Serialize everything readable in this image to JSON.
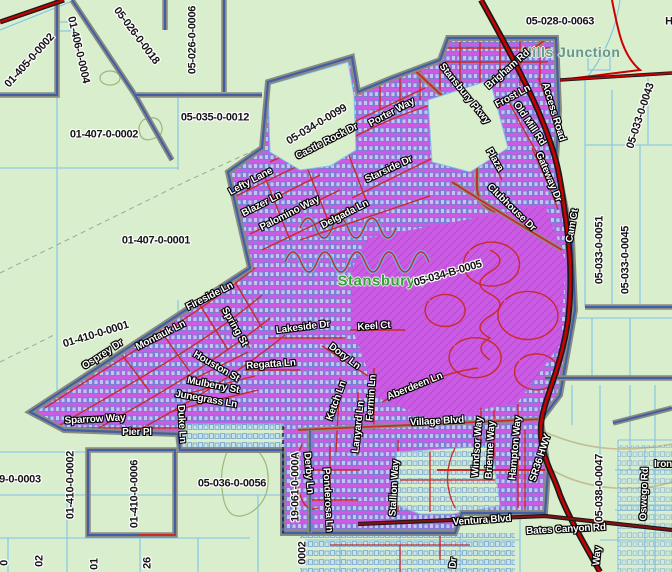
{
  "map": {
    "place_labels": [
      {
        "t": "Hills Junction",
        "x": 571,
        "y": 52,
        "r": 0,
        "k": "place-teal"
      },
      {
        "t": "Stansbury P",
        "x": 384,
        "y": 281,
        "r": 0,
        "k": "place-green"
      }
    ],
    "parcel_labels": [
      {
        "t": "01-405-0-0002",
        "x": 30,
        "y": 61,
        "r": -48
      },
      {
        "t": "01-406-0-0004",
        "x": 78,
        "y": 50,
        "r": 77
      },
      {
        "t": "05-026-0-0018",
        "x": 136,
        "y": 36,
        "r": 53
      },
      {
        "t": "05-026-0-0006",
        "x": 193,
        "y": 40,
        "r": -90
      },
      {
        "t": "05-028-0-0063",
        "x": 560,
        "y": 22,
        "r": 0
      },
      {
        "t": "05-035-0-0012",
        "x": 215,
        "y": 118,
        "r": 0
      },
      {
        "t": "01-407-0-0002",
        "x": 104,
        "y": 135,
        "r": 0
      },
      {
        "t": "05-034-0-0099",
        "x": 317,
        "y": 125,
        "r": -31
      },
      {
        "t": "05-033-0-0043",
        "x": 641,
        "y": 116,
        "r": -72
      },
      {
        "t": "01-407-0-0001",
        "x": 156,
        "y": 241,
        "r": 0
      },
      {
        "t": "05-034-B-0005",
        "x": 448,
        "y": 274,
        "r": -16
      },
      {
        "t": "05-033-0-0051",
        "x": 600,
        "y": 250,
        "r": -90
      },
      {
        "t": "05-033-0-0045",
        "x": 626,
        "y": 260,
        "r": -90
      },
      {
        "t": "01-410-0-0001",
        "x": 96,
        "y": 335,
        "r": -17
      },
      {
        "t": "9-0-0003",
        "x": 20,
        "y": 480,
        "r": 0
      },
      {
        "t": "01-410-0-0002",
        "x": 71,
        "y": 485,
        "r": -90
      },
      {
        "t": "01-410-0-0006",
        "x": 135,
        "y": 494,
        "r": -90
      },
      {
        "t": "05-036-0-0056",
        "x": 232,
        "y": 484,
        "r": 0
      },
      {
        "t": "19-061-0-000A",
        "x": 296,
        "y": 487,
        "r": -90
      },
      {
        "t": "05-038-0-0047",
        "x": 600,
        "y": 488,
        "r": -90
      },
      {
        "t": "0002",
        "x": 303,
        "y": 553,
        "r": -90
      },
      {
        "t": "0",
        "x": 5,
        "y": 563,
        "r": -90
      },
      {
        "t": "02",
        "x": 40,
        "y": 561,
        "r": -90
      },
      {
        "t": "01",
        "x": 95,
        "y": 564,
        "r": -90
      },
      {
        "t": "26",
        "x": 148,
        "y": 563,
        "r": -90
      },
      {
        "t": "H",
        "x": 669,
        "y": 22,
        "r": 0
      }
    ],
    "road_labels": [
      {
        "t": "Stansbury Pkwy",
        "x": 464,
        "y": 94,
        "r": 51
      },
      {
        "t": "Porter Way",
        "x": 392,
        "y": 113,
        "r": -28
      },
      {
        "t": "Castle Rock Dr",
        "x": 327,
        "y": 142,
        "r": -27
      },
      {
        "t": "Lefty Lane",
        "x": 251,
        "y": 182,
        "r": -28
      },
      {
        "t": "Blazer Ln",
        "x": 262,
        "y": 205,
        "r": -27
      },
      {
        "t": "Palomino Way",
        "x": 290,
        "y": 214,
        "r": -27
      },
      {
        "t": "Delgada Ln",
        "x": 345,
        "y": 215,
        "r": -27
      },
      {
        "t": "Starside Dr",
        "x": 389,
        "y": 170,
        "r": -25
      },
      {
        "t": "Brigham Rd",
        "x": 508,
        "y": 70,
        "r": -41
      },
      {
        "t": "Frost Ln",
        "x": 513,
        "y": 97,
        "r": -28
      },
      {
        "t": "Access Road",
        "x": 553,
        "y": 112,
        "r": 73
      },
      {
        "t": "Old Mill Rd",
        "x": 529,
        "y": 124,
        "r": 56
      },
      {
        "t": "Gateway Dr",
        "x": 548,
        "y": 177,
        "r": 67
      },
      {
        "t": "Plaza",
        "x": 494,
        "y": 160,
        "r": 60
      },
      {
        "t": "Clubhouse Dr",
        "x": 511,
        "y": 208,
        "r": 44
      },
      {
        "t": "Cam Ct",
        "x": 573,
        "y": 226,
        "r": -80
      },
      {
        "t": "Fireside Ln",
        "x": 210,
        "y": 297,
        "r": -27
      },
      {
        "t": "Osprey Dr",
        "x": 103,
        "y": 355,
        "r": -33
      },
      {
        "t": "Montauk Ln",
        "x": 161,
        "y": 336,
        "r": -27
      },
      {
        "t": "Spring St",
        "x": 234,
        "y": 327,
        "r": 60
      },
      {
        "t": "Lakeside Dr",
        "x": 303,
        "y": 328,
        "r": -7
      },
      {
        "t": "Keel Ct",
        "x": 374,
        "y": 327,
        "r": -4
      },
      {
        "t": "Dory Ln",
        "x": 344,
        "y": 357,
        "r": 37
      },
      {
        "t": "Houston St",
        "x": 216,
        "y": 367,
        "r": 30
      },
      {
        "t": "Regatta Ln",
        "x": 271,
        "y": 365,
        "r": -4
      },
      {
        "t": "Mulberry St",
        "x": 213,
        "y": 386,
        "r": 11
      },
      {
        "t": "Junegrass Ln",
        "x": 206,
        "y": 400,
        "r": 10
      },
      {
        "t": "Sparrow Way",
        "x": 95,
        "y": 420,
        "r": -3
      },
      {
        "t": "Pier Pl",
        "x": 137,
        "y": 433,
        "r": 0
      },
      {
        "t": "Duke Ln",
        "x": 181,
        "y": 424,
        "r": 87
      },
      {
        "t": "Ketch Ln",
        "x": 337,
        "y": 401,
        "r": -70
      },
      {
        "t": "Fermin Ln",
        "x": 372,
        "y": 398,
        "r": -86
      },
      {
        "t": "Lanyard Ln",
        "x": 359,
        "y": 427,
        "r": -84
      },
      {
        "t": "Aberdeen Ln",
        "x": 415,
        "y": 387,
        "r": -22
      },
      {
        "t": "Village Blvd",
        "x": 437,
        "y": 422,
        "r": -3
      },
      {
        "t": "Windsor Way",
        "x": 478,
        "y": 447,
        "r": -86
      },
      {
        "t": "Brienne Way",
        "x": 491,
        "y": 450,
        "r": -87
      },
      {
        "t": "Hampton Way",
        "x": 516,
        "y": 448,
        "r": -85
      },
      {
        "t": "Stallion Way",
        "x": 395,
        "y": 488,
        "r": -87
      },
      {
        "t": "Derby Ln",
        "x": 308,
        "y": 473,
        "r": 85
      },
      {
        "t": "Ponderosa Ln",
        "x": 327,
        "y": 500,
        "r": 87
      },
      {
        "t": "SR36 HWY",
        "x": 541,
        "y": 458,
        "r": -72
      },
      {
        "t": "Ventura Blvd",
        "x": 482,
        "y": 521,
        "r": -4
      },
      {
        "t": "Bates Canyon Rd",
        "x": 566,
        "y": 530,
        "r": -3
      },
      {
        "t": "Oswego Rd",
        "x": 645,
        "y": 494,
        "r": -88
      },
      {
        "t": "Iron",
        "x": 663,
        "y": 465,
        "r": 0
      },
      {
        "t": "Way",
        "x": 598,
        "y": 556,
        "r": -85
      },
      {
        "t": "Dr",
        "x": 454,
        "y": 563,
        "r": -85
      }
    ],
    "colors": {
      "background": "#d9eecd",
      "subdivision_fill": "#cc5be4",
      "subdivision_hatch": "#b84ed8",
      "street_red": "#c92a2a",
      "highway_red": "#cc0000",
      "highway_casing": "#1a1a1a",
      "house_fill": "#bfe0f8",
      "house_line": "#4f87c8",
      "parcel_line_blue": "#7fc3ea",
      "boundary_casing": "#8a8a80",
      "boundary_core": "#3f5fa8",
      "parcel_label": "#141414",
      "road_label": "#ffffff",
      "place_teal": "#64988c",
      "place_green": "#35a13c"
    }
  }
}
